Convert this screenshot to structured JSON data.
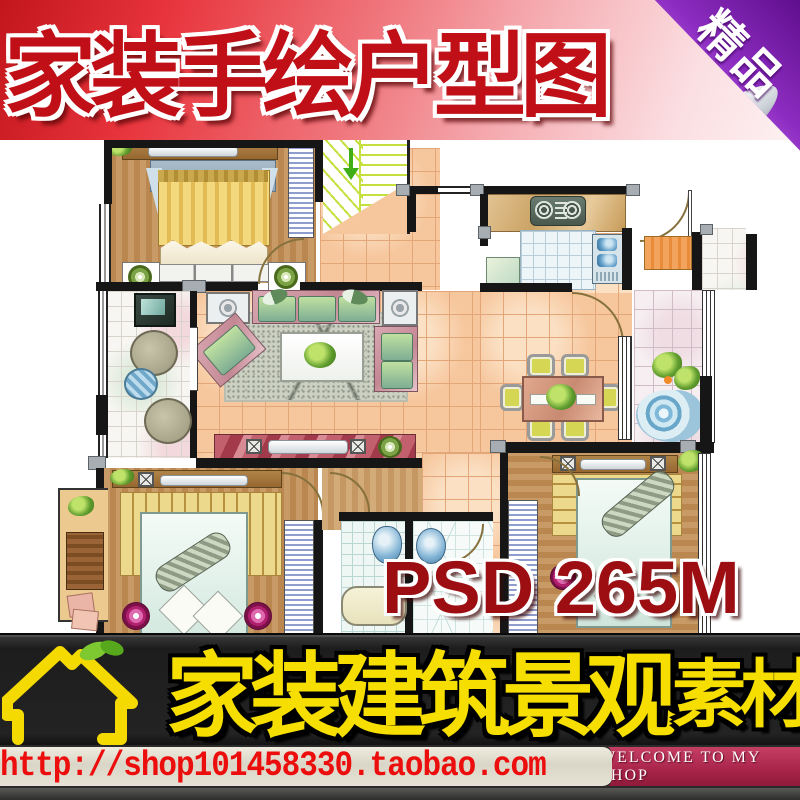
{
  "top_banner": {
    "title": "家装手绘户型图",
    "bg_left_color": "#e8343c",
    "bg_right_color": "#fdf1f2",
    "text_color": "#c00f16"
  },
  "corner_badge": {
    "label": "精品",
    "color": "#8c2cc0"
  },
  "watermark": {
    "text": "PSD 265M",
    "color": "#9c0e12"
  },
  "bottom_banner": {
    "title_main": "家装建筑景观",
    "title_suffix": "素材",
    "text_color": "#f6df00",
    "bg_color": "#232323",
    "logo": "house-icon",
    "logo_accent": "leaf-icon"
  },
  "url_bar": {
    "url": "http://shop101458330.taobao.com",
    "text_color": "#ec0d0d",
    "bg_color": "#dedbcc"
  },
  "shop_tag": {
    "label": "WELCOME TO MY SHOP",
    "bg_color": "#a92449",
    "text_color": "#ffffff"
  },
  "floor_plan": {
    "style": "hand-drawn watercolor apartment plan",
    "rooms": [
      "master-bedroom",
      "stairwell",
      "kitchen",
      "entry-hall",
      "living-room",
      "dining-area",
      "left-balcony",
      "right-balcony",
      "outer-balcony",
      "bedroom-2",
      "bathroom",
      "bedroom-3"
    ],
    "furniture_icons": [
      "double-bed",
      "wardrobe-hangers",
      "sofa-set",
      "coffee-table",
      "tv-cabinet",
      "dining-table-six-chairs",
      "stove",
      "double-sink",
      "bathtub",
      "toilet",
      "round-tables",
      "lounger",
      "water-feature",
      "plants"
    ]
  }
}
